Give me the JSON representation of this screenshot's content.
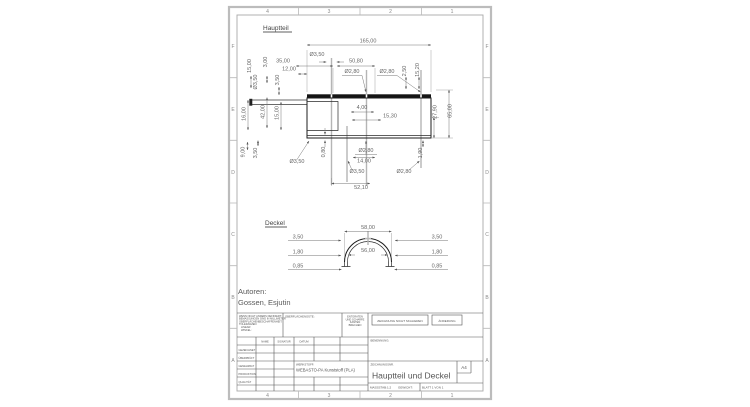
{
  "palette": {
    "paper": "#ffffff",
    "outline": "#1c1c1c",
    "dimension_text": "#666666",
    "frame_gray": "#b9b9b9",
    "title_text": "#555555"
  },
  "sheet": {
    "zones_top": [
      "4",
      "3",
      "2",
      "1"
    ],
    "zones_bottom": [
      "4",
      "3",
      "2",
      "1"
    ],
    "zones_left": [
      "F",
      "E",
      "D",
      "C",
      "B",
      "A"
    ],
    "zones_right": [
      "F",
      "E",
      "D",
      "C",
      "B",
      "A"
    ]
  },
  "views": {
    "hauptteil": {
      "label": "Hauptteil",
      "dims": [
        "165,00",
        "Ø3,50",
        "35,00",
        "50,80",
        "12,00",
        "Ø2,80",
        "Ø2,80",
        "2,50",
        "15,20",
        "15,00",
        "3,00",
        "Ø3,50",
        "3,50",
        "42,00",
        "15,00",
        "16,00",
        "4,00",
        "15,30",
        "27,90",
        "65,00",
        "0,80",
        "Ø2,80",
        "14,00",
        "9,00",
        "3,50",
        "Ø3,50",
        "Ø3,50",
        "Ø2,80",
        "1,90",
        "52,10"
      ]
    },
    "deckel": {
      "label": "Deckel",
      "dims": [
        "58,00",
        "56,00",
        "3,50",
        "1,80",
        "0,85",
        "3,50",
        "1,80",
        "0,85"
      ]
    }
  },
  "authors": {
    "label": "Autoren:",
    "names": "Gossen, Esjutin"
  },
  "title_block": {
    "notes": [
      "WENN NICHT ANDERS DEFINIERT:",
      "BEMASSUNGEN SIND IN MILLIMETER",
      "OBERFLÄCHENBESCHAFFENHEIT:",
      "TOLERANZEN:",
      "LINEAR:",
      "WINKEL:"
    ],
    "surface_finish_label": "OBERFLÄCHENGÜTE:",
    "deburr_lines": [
      "ENTGRATEN",
      "UND SCHARFE",
      "KANTEN",
      "BRECHEN"
    ],
    "do_not_scale": "ZEICHNUNG NICHT SKALIEREN",
    "revision_label": "ÄNDERUNG",
    "table_headers": [
      "NAME",
      "SIGNATUR",
      "DATUM"
    ],
    "table_rows": [
      "GEZEICHNET",
      "ÜBERPRÜFT",
      "GENEHMIGT",
      "PRODUKTION",
      "QUALITÄT"
    ],
    "material_label": "WERKSTOFF:",
    "material_value": "WEBASTO-PA Kunststoff (PLA)",
    "title_label": "BENENNUNG:",
    "drawing_no_label": "ZEICHNUNGSNR.",
    "drawing_title": "Hauptteil und Deckel",
    "sheet_size": "A4",
    "scale_label": "MASSSTAB:1:2",
    "weight_label": "GEWICHT:",
    "sheet_label": "BLATT 1 VON 1"
  }
}
